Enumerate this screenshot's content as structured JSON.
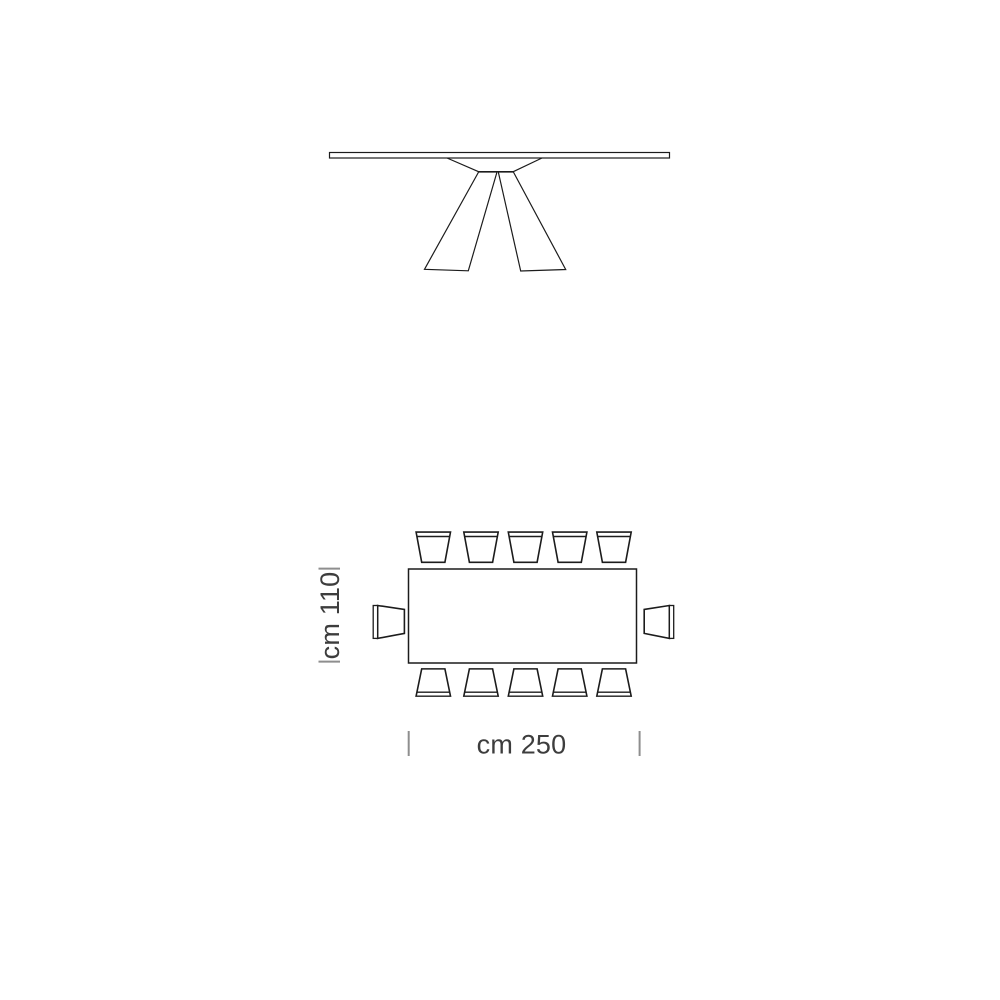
{
  "diagram": {
    "kind": "furniture-technical-dimension-drawing",
    "views": {
      "elevation": {
        "name": "table front elevation"
      },
      "plan": {
        "name": "table plan view with seating",
        "chairs_top_row": 5,
        "chairs_bottom_row": 5,
        "chairs_left_end": 1,
        "chairs_right_end": 1,
        "chairs_total": 12
      }
    },
    "dimensions": {
      "depth_label": "cm 110",
      "width_label": "cm 250"
    },
    "colors": {
      "background": "#ffffff",
      "line": "#1c1c1c",
      "tick": "#8e8e8e",
      "label_text": "#3d3d3d"
    }
  }
}
